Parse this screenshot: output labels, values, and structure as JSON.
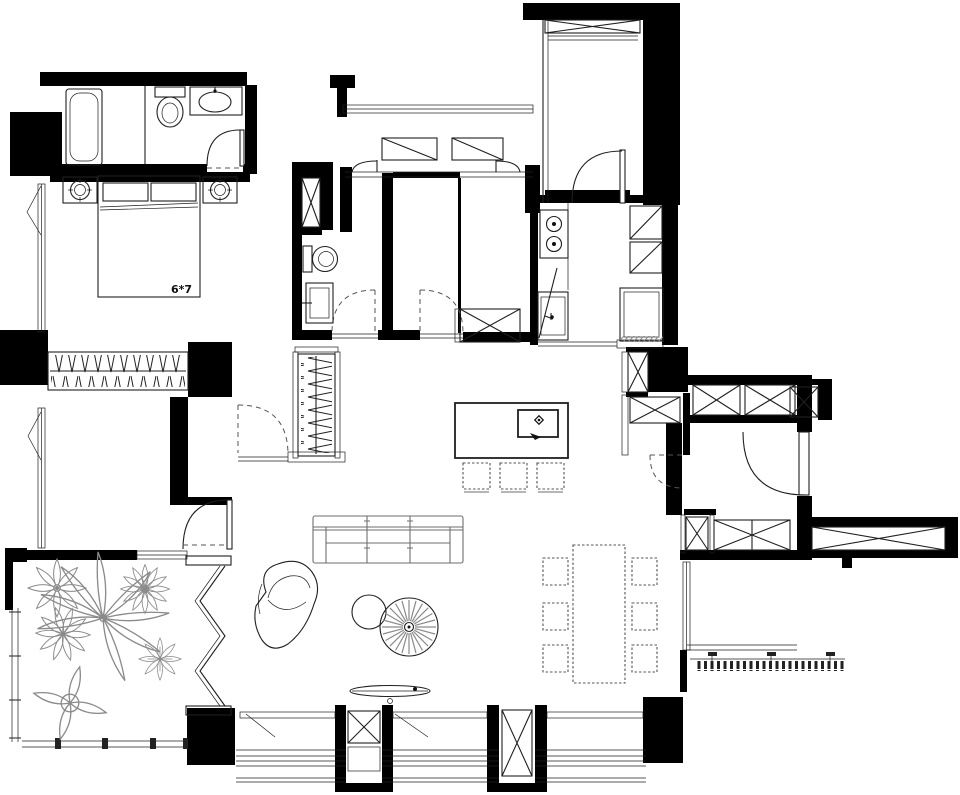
{
  "meta": {
    "drawing_type": "residential apartment floor plan",
    "view": "top-down CAD plan"
  },
  "labels": {
    "bed_size": "6*7"
  },
  "colors": {
    "wall": "#000000",
    "line": "#1f1f1f",
    "furniture": "#6e6e6e",
    "soft": "#8a8a8a",
    "dash": "#555555",
    "bg": "#ffffff"
  },
  "symbols": [
    "bathtub",
    "toilet",
    "washbasin",
    "double-bed",
    "nightstand",
    "wardrobe-hangers",
    "walk-in-closet",
    "sofa",
    "armchair",
    "side-table",
    "round-rug",
    "coffee-table",
    "dining-table",
    "dining-chair",
    "kitchen-island-sink",
    "bar-stool",
    "cooktop",
    "kitchen-sink",
    "refrigerator",
    "washing-machine",
    "duct-shaft",
    "storage-cabinet",
    "door-swing",
    "folding-door",
    "window",
    "balcony-railing",
    "potted-plant"
  ]
}
